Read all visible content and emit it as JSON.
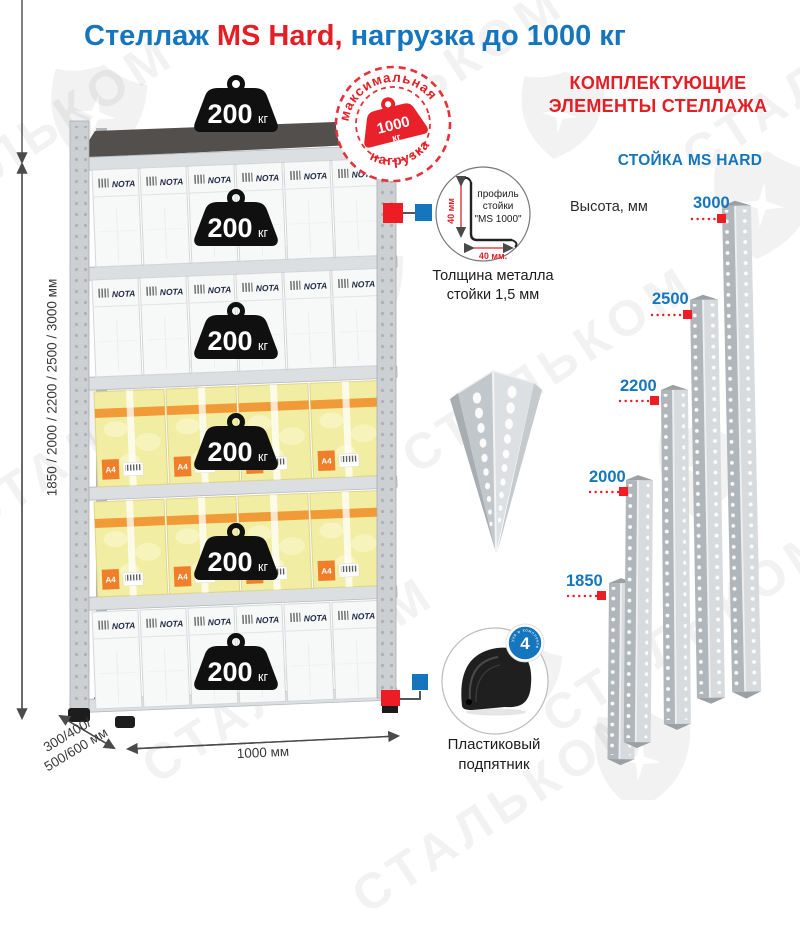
{
  "title": {
    "prefix": "Стеллаж ",
    "accent": "MS Hard,",
    "suffix": " нагрузка до 1000 кг"
  },
  "watermark": {
    "text": "СТАЛЬКОМ"
  },
  "rack": {
    "load_badge": {
      "value": "200",
      "unit": "кг"
    },
    "max_load_badge": {
      "arc_top": "максимальная",
      "arc_bottom": "нагрузка",
      "value": "1000",
      "unit": "кг"
    },
    "box_brand": "NOTA",
    "paper_size_label": "A4",
    "dim_height": "1850 / 2000 / 2200 / 2500 / 3000 мм",
    "dim_depth_line1": "300/400/",
    "dim_depth_line2": "500/600 мм",
    "dim_width": "1000 мм"
  },
  "details": {
    "profile": {
      "label_line1": "профиль",
      "label_line2": "стойки",
      "label_line3": "\"MS 1000\"",
      "dim_vertical": "40 мм",
      "dim_horizontal": "40 мм.",
      "caption_line1": "Толщина металла",
      "caption_line2": "стойки 1,5 мм"
    },
    "foot": {
      "badge_count": "4",
      "badge_arc": "штуки в комплекте",
      "caption_line1": "Пластиковый",
      "caption_line2": "подпятник"
    }
  },
  "components": {
    "heading_line1": "КОМПЛЕКТУЮЩИЕ",
    "heading_line2": "ЭЛЕМЕНТЫ СТЕЛЛАЖА",
    "subheading": "СТОЙКА MS HARD",
    "height_label": "Высота, мм",
    "post_heights": [
      {
        "label": "3000"
      },
      {
        "label": "2500"
      },
      {
        "label": "2200"
      },
      {
        "label": "2000"
      },
      {
        "label": "1850"
      }
    ]
  },
  "colors": {
    "accent_blue": "#1576bd",
    "accent_red": "#e31e24",
    "marker_red": "#ee1c25"
  }
}
